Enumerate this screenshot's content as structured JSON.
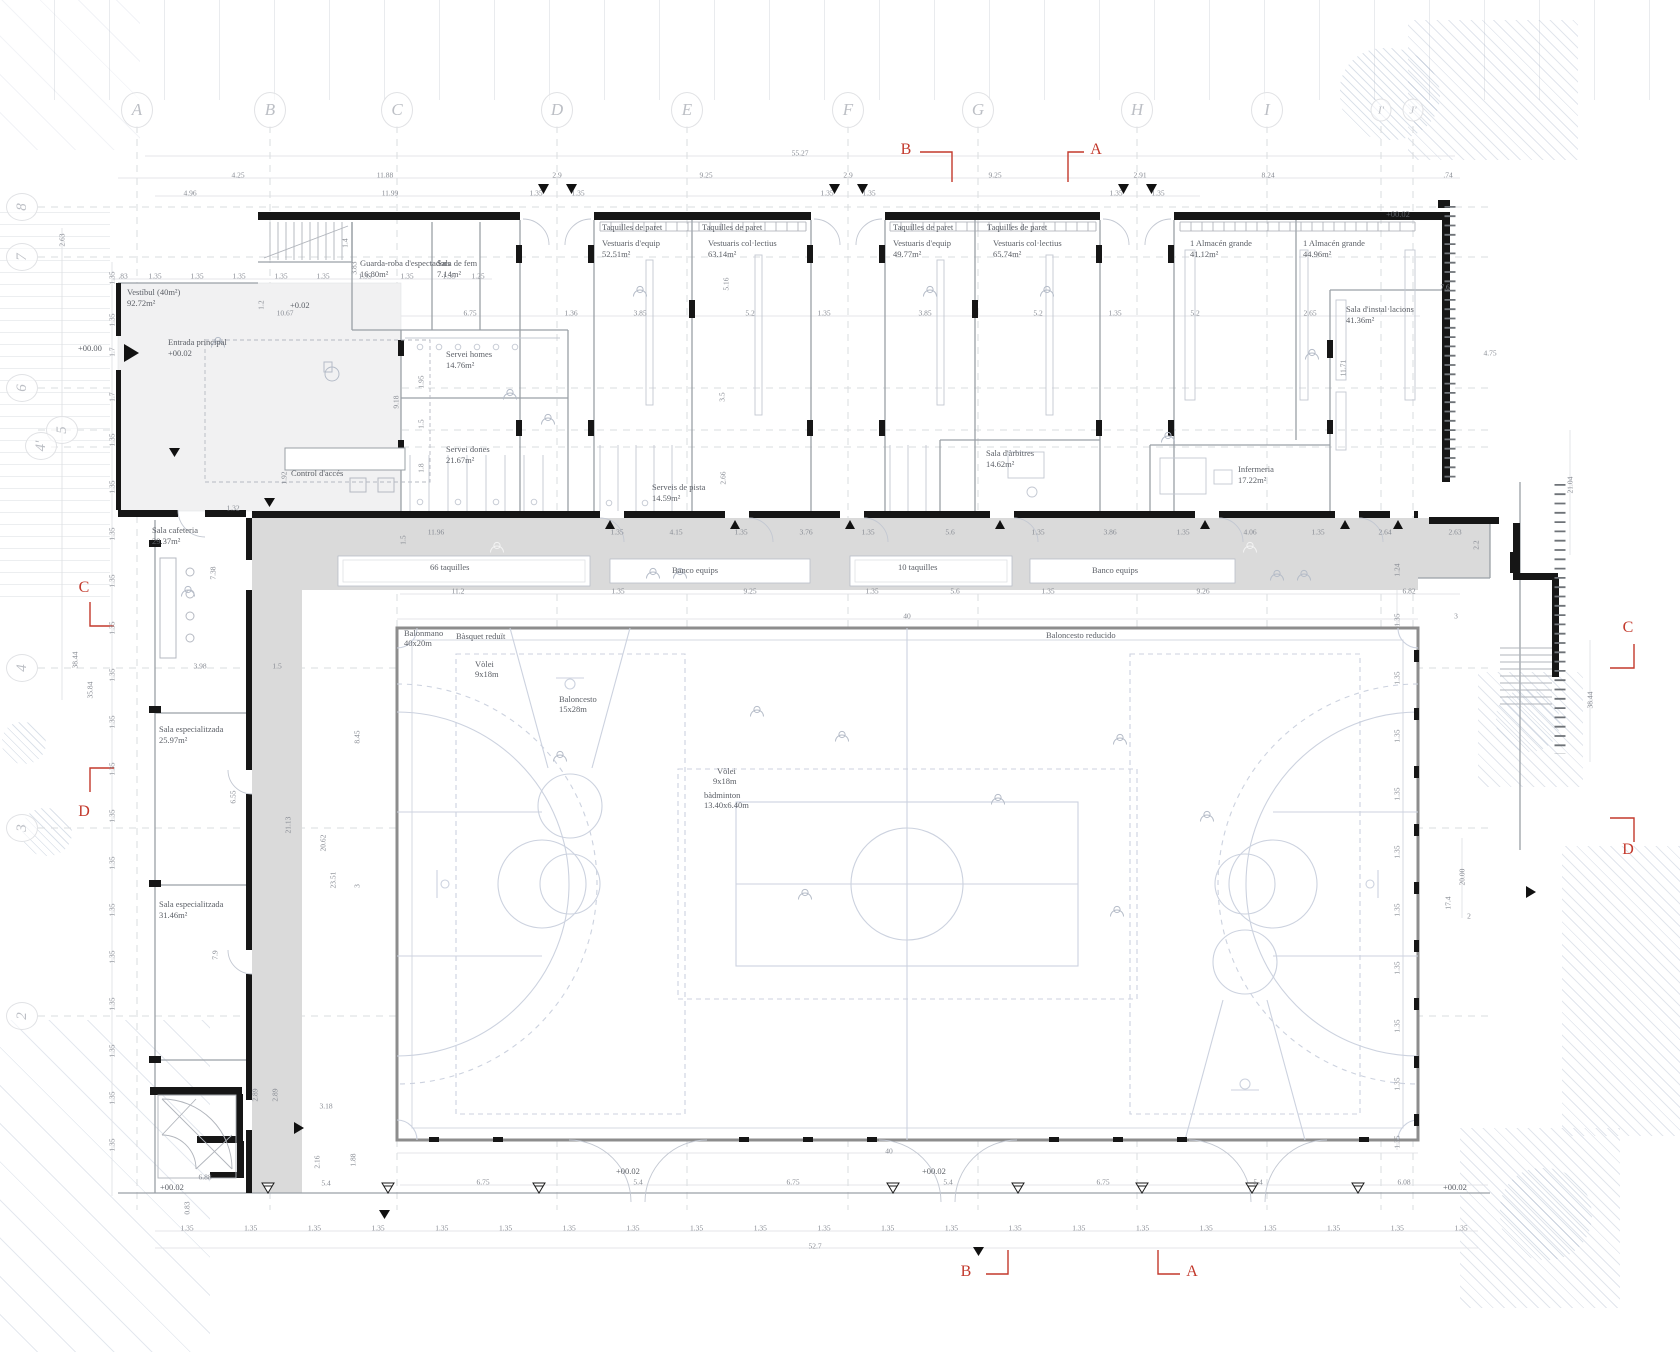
{
  "plan": {
    "colors": {
      "section_red": "#c3392c",
      "wall_black": "#161616",
      "corridor_gray": "#dadada",
      "court_line": "#ccd2df",
      "dim_gray": "#878b93"
    },
    "grid_letters": [
      {
        "t": "A",
        "x": 137,
        "y": 110
      },
      {
        "t": "B",
        "x": 270,
        "y": 110
      },
      {
        "t": "C",
        "x": 397,
        "y": 110
      },
      {
        "t": "D",
        "x": 557,
        "y": 110
      },
      {
        "t": "E",
        "x": 687,
        "y": 110
      },
      {
        "t": "F",
        "x": 848,
        "y": 110
      },
      {
        "t": "G",
        "x": 978,
        "y": 110
      },
      {
        "t": "H",
        "x": 1137,
        "y": 110
      },
      {
        "t": "I",
        "x": 1267,
        "y": 110
      },
      {
        "t": "I'",
        "x": 1381,
        "y": 110,
        "s": 1
      },
      {
        "t": "J'",
        "x": 1413,
        "y": 110,
        "s": 1
      }
    ],
    "grid_numbers": [
      {
        "t": "8",
        "x": 22,
        "y": 207
      },
      {
        "t": "7",
        "x": 22,
        "y": 257
      },
      {
        "t": "6",
        "x": 22,
        "y": 388
      },
      {
        "t": "5",
        "x": 62,
        "y": 430
      },
      {
        "t": "4'",
        "x": 41,
        "y": 446
      },
      {
        "t": "4",
        "x": 22,
        "y": 668
      },
      {
        "t": "3",
        "x": 22,
        "y": 828
      },
      {
        "t": "2",
        "x": 22,
        "y": 1016
      }
    ],
    "sections": {
      "top_b": "B",
      "top_a": "A",
      "bottom_b": "B",
      "bottom_a": "A",
      "left_c": "C",
      "left_d": "D",
      "right_c": "C",
      "right_d": "D"
    },
    "rooms": [
      {
        "name": "Vestíbul (40m²)",
        "area": "92.72m²",
        "x": 127,
        "y": 287
      },
      {
        "name": "Guarda-roba d'espectadors",
        "area": "16.80m²",
        "x": 360,
        "y": 258
      },
      {
        "name": "Sala de fem",
        "area": "7.14m²",
        "x": 437,
        "y": 258
      },
      {
        "name": "Vestuaris d'equip",
        "area": "52.51m²",
        "x": 602,
        "y": 238
      },
      {
        "name": "Vestuaris col·lectius",
        "area": "63.14m²",
        "x": 708,
        "y": 238
      },
      {
        "name": "Vestuaris d'equip",
        "area": "49.77m²",
        "x": 893,
        "y": 238
      },
      {
        "name": "Vestuaris col·lectius",
        "area": "65.74m²",
        "x": 993,
        "y": 238
      },
      {
        "name": "1 Almacén grande",
        "area": "41.12m²",
        "x": 1190,
        "y": 238
      },
      {
        "name": "1 Almacén grande",
        "area": "44.96m²",
        "x": 1303,
        "y": 238
      },
      {
        "name": "Sala d'instal·lacions",
        "area": "41.36m²",
        "x": 1346,
        "y": 304
      },
      {
        "name": "Entrada principal",
        "area": "+00.02",
        "x": 168,
        "y": 337
      },
      {
        "name": "Servei homes",
        "area": "14.76m²",
        "x": 446,
        "y": 349
      },
      {
        "name": "Servei dones",
        "area": "21.67m²",
        "x": 446,
        "y": 444
      },
      {
        "name": "Control d'accés",
        "area": "",
        "x": 291,
        "y": 468
      },
      {
        "name": "Serveis de pista",
        "area": "14.59m²",
        "x": 652,
        "y": 482
      },
      {
        "name": "Sala d'àrbitres",
        "area": "14.62m²",
        "x": 986,
        "y": 448
      },
      {
        "name": "Infermeria",
        "area": "17.22m²",
        "x": 1238,
        "y": 464
      },
      {
        "name": "Sala cafeteria",
        "area": "29.37m²",
        "x": 152,
        "y": 525
      },
      {
        "name": "Sala especialitzada",
        "area": "25.97m²",
        "x": 159,
        "y": 724
      },
      {
        "name": "Sala especialitzada",
        "area": "31.46m²",
        "x": 159,
        "y": 899
      }
    ],
    "labels": [
      {
        "t": "Taquilles de paret",
        "x": 602,
        "y": 222
      },
      {
        "t": "Taquilles de paret",
        "x": 702,
        "y": 222
      },
      {
        "t": "Taquilles de paret",
        "x": 893,
        "y": 222
      },
      {
        "t": "Taquilles de paret",
        "x": 987,
        "y": 222
      },
      {
        "t": "66 taquilles",
        "x": 430,
        "y": 562
      },
      {
        "t": "Banco equips",
        "x": 672,
        "y": 565
      },
      {
        "t": "10 taquilles",
        "x": 898,
        "y": 562
      },
      {
        "t": "Banco equips",
        "x": 1092,
        "y": 565
      },
      {
        "t": "Balonmano",
        "x": 404,
        "y": 628
      },
      {
        "t": "40x20m",
        "x": 404,
        "y": 638
      },
      {
        "t": "Bàsquet reduït",
        "x": 456,
        "y": 631
      },
      {
        "t": "Vòlei",
        "x": 475,
        "y": 659
      },
      {
        "t": "9x18m",
        "x": 475,
        "y": 669
      },
      {
        "t": "Baloncesto",
        "x": 559,
        "y": 694
      },
      {
        "t": "15x28m",
        "x": 559,
        "y": 704
      },
      {
        "t": "Vòlei",
        "x": 717,
        "y": 766
      },
      {
        "t": "9x18m",
        "x": 713,
        "y": 776
      },
      {
        "t": "bàdminton",
        "x": 704,
        "y": 790
      },
      {
        "t": "13.40x6.40m",
        "x": 704,
        "y": 800
      },
      {
        "t": "Baloncesto reducido",
        "x": 1046,
        "y": 630
      },
      {
        "t": "+00.00",
        "x": 78,
        "y": 343
      },
      {
        "t": "+0.02",
        "x": 290,
        "y": 300
      },
      {
        "t": "+00.02",
        "x": 1386,
        "y": 209
      },
      {
        "t": "+00.02",
        "x": 160,
        "y": 1182
      },
      {
        "t": "+00.02",
        "x": 616,
        "y": 1166
      },
      {
        "t": "+00.02",
        "x": 922,
        "y": 1166
      },
      {
        "t": "+00.02",
        "x": 1443,
        "y": 1182
      }
    ],
    "dims": [
      {
        "t": "55.27",
        "x": 800,
        "y": 153
      },
      {
        "t": "4.25",
        "x": 238,
        "y": 175
      },
      {
        "t": "11.88",
        "x": 385,
        "y": 175
      },
      {
        "t": "2.9",
        "x": 557,
        "y": 175
      },
      {
        "t": "9.25",
        "x": 706,
        "y": 175
      },
      {
        "t": "2.9",
        "x": 848,
        "y": 175
      },
      {
        "t": "9.25",
        "x": 995,
        "y": 175
      },
      {
        "t": "2.91",
        "x": 1140,
        "y": 175
      },
      {
        "t": "8.24",
        "x": 1268,
        "y": 175
      },
      {
        "t": ".74",
        "x": 1448,
        "y": 175
      },
      {
        "t": "4.96",
        "x": 190,
        "y": 193
      },
      {
        "t": "11.99",
        "x": 390,
        "y": 193
      },
      {
        "t": "1.35",
        "x": 536,
        "y": 193
      },
      {
        "t": "1.35",
        "x": 578,
        "y": 193
      },
      {
        "t": "1.35",
        "x": 827,
        "y": 193
      },
      {
        "t": "1.35",
        "x": 869,
        "y": 193
      },
      {
        "t": "1.35",
        "x": 1116,
        "y": 193
      },
      {
        "t": "1.35",
        "x": 1158,
        "y": 193
      },
      {
        "t": ".83",
        "x": 123,
        "y": 276
      },
      {
        "t": "1.35",
        "x": 155,
        "y": 276
      },
      {
        "t": "1.35",
        "x": 197,
        "y": 276
      },
      {
        "t": "1.35",
        "x": 239,
        "y": 276
      },
      {
        "t": "1.35",
        "x": 281,
        "y": 276
      },
      {
        "t": "1.35",
        "x": 323,
        "y": 276
      },
      {
        "t": "1.35",
        "x": 365,
        "y": 276
      },
      {
        "t": "1.35",
        "x": 407,
        "y": 276
      },
      {
        "t": "1.35",
        "x": 449,
        "y": 276
      },
      {
        "t": "1.25",
        "x": 478,
        "y": 276
      },
      {
        "t": "10.67",
        "x": 285,
        "y": 313
      },
      {
        "t": "6.75",
        "x": 470,
        "y": 313
      },
      {
        "t": "1.36",
        "x": 571,
        "y": 313
      },
      {
        "t": "3.85",
        "x": 640,
        "y": 313
      },
      {
        "t": "5.2",
        "x": 750,
        "y": 313
      },
      {
        "t": "1.35",
        "x": 824,
        "y": 313
      },
      {
        "t": "3.85",
        "x": 925,
        "y": 313
      },
      {
        "t": "5.2",
        "x": 1038,
        "y": 313
      },
      {
        "t": "1.35",
        "x": 1115,
        "y": 313
      },
      {
        "t": "5.2",
        "x": 1195,
        "y": 313
      },
      {
        "t": "2.65",
        "x": 1310,
        "y": 313
      },
      {
        "t": "7.6",
        "x": 1445,
        "y": 287
      },
      {
        "t": "4.75",
        "x": 1490,
        "y": 353
      },
      {
        "t": "1.4",
        "x": 345,
        "y": 243,
        "r": 1
      },
      {
        "t": "3.83",
        "x": 354,
        "y": 268,
        "r": 1
      },
      {
        "t": "1.2",
        "x": 261,
        "y": 305,
        "r": 1
      },
      {
        "t": "9.18",
        "x": 396,
        "y": 402,
        "r": 1
      },
      {
        "t": "1.95",
        "x": 421,
        "y": 382,
        "r": 1
      },
      {
        "t": "1.5",
        "x": 421,
        "y": 424,
        "r": 1
      },
      {
        "t": "1.8",
        "x": 421,
        "y": 468,
        "r": 1
      },
      {
        "t": "5.16",
        "x": 726,
        "y": 284,
        "r": 1
      },
      {
        "t": "3.5",
        "x": 722,
        "y": 397,
        "r": 1
      },
      {
        "t": "2.66",
        "x": 723,
        "y": 478,
        "r": 1
      },
      {
        "t": "11.71",
        "x": 1343,
        "y": 368,
        "r": 1
      },
      {
        "t": "11.96",
        "x": 436,
        "y": 532
      },
      {
        "t": "1.35",
        "x": 617,
        "y": 532
      },
      {
        "t": "4.15",
        "x": 676,
        "y": 532
      },
      {
        "t": "1.35",
        "x": 741,
        "y": 532
      },
      {
        "t": "3.76",
        "x": 806,
        "y": 532
      },
      {
        "t": "1.35",
        "x": 868,
        "y": 532
      },
      {
        "t": "5.6",
        "x": 950,
        "y": 532
      },
      {
        "t": "1.35",
        "x": 1038,
        "y": 532
      },
      {
        "t": "3.86",
        "x": 1110,
        "y": 532
      },
      {
        "t": "1.35",
        "x": 1183,
        "y": 532
      },
      {
        "t": "4.06",
        "x": 1250,
        "y": 532
      },
      {
        "t": "1.35",
        "x": 1318,
        "y": 532
      },
      {
        "t": "2.64",
        "x": 1385,
        "y": 532
      },
      {
        "t": "2.63",
        "x": 1455,
        "y": 532
      },
      {
        "t": "1.32",
        "x": 233,
        "y": 508
      },
      {
        "t": "1.92",
        "x": 284,
        "y": 478,
        "r": 1
      },
      {
        "t": "1.5",
        "x": 403,
        "y": 540,
        "r": 1
      },
      {
        "t": "11.2",
        "x": 458,
        "y": 591
      },
      {
        "t": "1.35",
        "x": 618,
        "y": 591
      },
      {
        "t": "9.25",
        "x": 750,
        "y": 591
      },
      {
        "t": "1.35",
        "x": 872,
        "y": 591
      },
      {
        "t": "5.6",
        "x": 955,
        "y": 591
      },
      {
        "t": "1.35",
        "x": 1048,
        "y": 591
      },
      {
        "t": "9.26",
        "x": 1203,
        "y": 591
      },
      {
        "t": "6.82",
        "x": 1409,
        "y": 591
      },
      {
        "t": "40",
        "x": 907,
        "y": 616
      },
      {
        "t": "3",
        "x": 1456,
        "y": 616
      },
      {
        "t": "40",
        "x": 889,
        "y": 1151
      },
      {
        "t": "7.38",
        "x": 213,
        "y": 573,
        "r": 1
      },
      {
        "t": "3.98",
        "x": 200,
        "y": 666
      },
      {
        "t": "1.5",
        "x": 277,
        "y": 666
      },
      {
        "t": "6.55",
        "x": 233,
        "y": 797,
        "r": 1
      },
      {
        "t": "7.9",
        "x": 215,
        "y": 955,
        "r": 1
      },
      {
        "t": "3.18",
        "x": 326,
        "y": 1106
      },
      {
        "t": "2.89",
        "x": 255,
        "y": 1095,
        "r": 1
      },
      {
        "t": "2.89",
        "x": 275,
        "y": 1095,
        "r": 1
      },
      {
        "t": "2.16",
        "x": 317,
        "y": 1162,
        "r": 1
      },
      {
        "t": "1.88",
        "x": 353,
        "y": 1160,
        "r": 1
      },
      {
        "t": "5.4",
        "x": 326,
        "y": 1183
      },
      {
        "t": "6.88",
        "x": 205,
        "y": 1177
      },
      {
        "t": "0.83",
        "x": 187,
        "y": 1208,
        "r": 1
      },
      {
        "t": "8.45",
        "x": 357,
        "y": 737,
        "r": 1
      },
      {
        "t": "21.13",
        "x": 288,
        "y": 825,
        "r": 1
      },
      {
        "t": "20.62",
        "x": 323,
        "y": 843,
        "r": 1
      },
      {
        "t": "23.51",
        "x": 333,
        "y": 880,
        "r": 1
      },
      {
        "t": "3",
        "x": 357,
        "y": 886,
        "r": 1
      },
      {
        "t": "1.24",
        "x": 1397,
        "y": 570,
        "r": 1
      },
      {
        "t": "2.2",
        "x": 1476,
        "y": 545,
        "r": 1
      },
      {
        "t": "21.04",
        "x": 1570,
        "y": 485,
        "r": 1
      },
      {
        "t": "38.44",
        "x": 1590,
        "y": 700,
        "r": 1
      },
      {
        "t": "20.00",
        "x": 1462,
        "y": 877,
        "r": 1
      },
      {
        "t": "17.4",
        "x": 1448,
        "y": 903,
        "r": 1
      },
      {
        "t": "2",
        "x": 1469,
        "y": 916
      },
      {
        "t": "6.75",
        "x": 483,
        "y": 1182
      },
      {
        "t": "5.4",
        "x": 638,
        "y": 1182
      },
      {
        "t": "6.75",
        "x": 793,
        "y": 1182
      },
      {
        "t": "5.4",
        "x": 948,
        "y": 1182
      },
      {
        "t": "6.75",
        "x": 1103,
        "y": 1182
      },
      {
        "t": "5.4",
        "x": 1258,
        "y": 1182
      },
      {
        "t": "6.08",
        "x": 1404,
        "y": 1182
      },
      {
        "t": "52.7",
        "x": 815,
        "y": 1246
      },
      {
        "t": "2.63",
        "x": 62,
        "y": 240,
        "r": 1
      },
      {
        "t": "38.44",
        "x": 75,
        "y": 660,
        "r": 1
      },
      {
        "t": "35.84",
        "x": 90,
        "y": 690,
        "r": 1
      },
      {
        "t": "1.35",
        "x": 112,
        "y": 278,
        "r": 1
      },
      {
        "t": "1.35",
        "x": 112,
        "y": 320,
        "r": 1
      },
      {
        "t": "1.7",
        "x": 112,
        "y": 352,
        "r": 1
      },
      {
        "t": "1.7",
        "x": 112,
        "y": 397,
        "r": 1
      }
    ],
    "dim_runs": [
      {
        "t": "1.35",
        "x": 112,
        "y0": 440,
        "dy": 47,
        "n": 16,
        "r": 1
      },
      {
        "t": "1.35",
        "x0": 187,
        "dx": 63.7,
        "y": 1228,
        "n": 21
      },
      {
        "t": "1.35",
        "x": 1397,
        "y0": 620,
        "dy": 58,
        "n": 10,
        "r": 1
      }
    ]
  }
}
